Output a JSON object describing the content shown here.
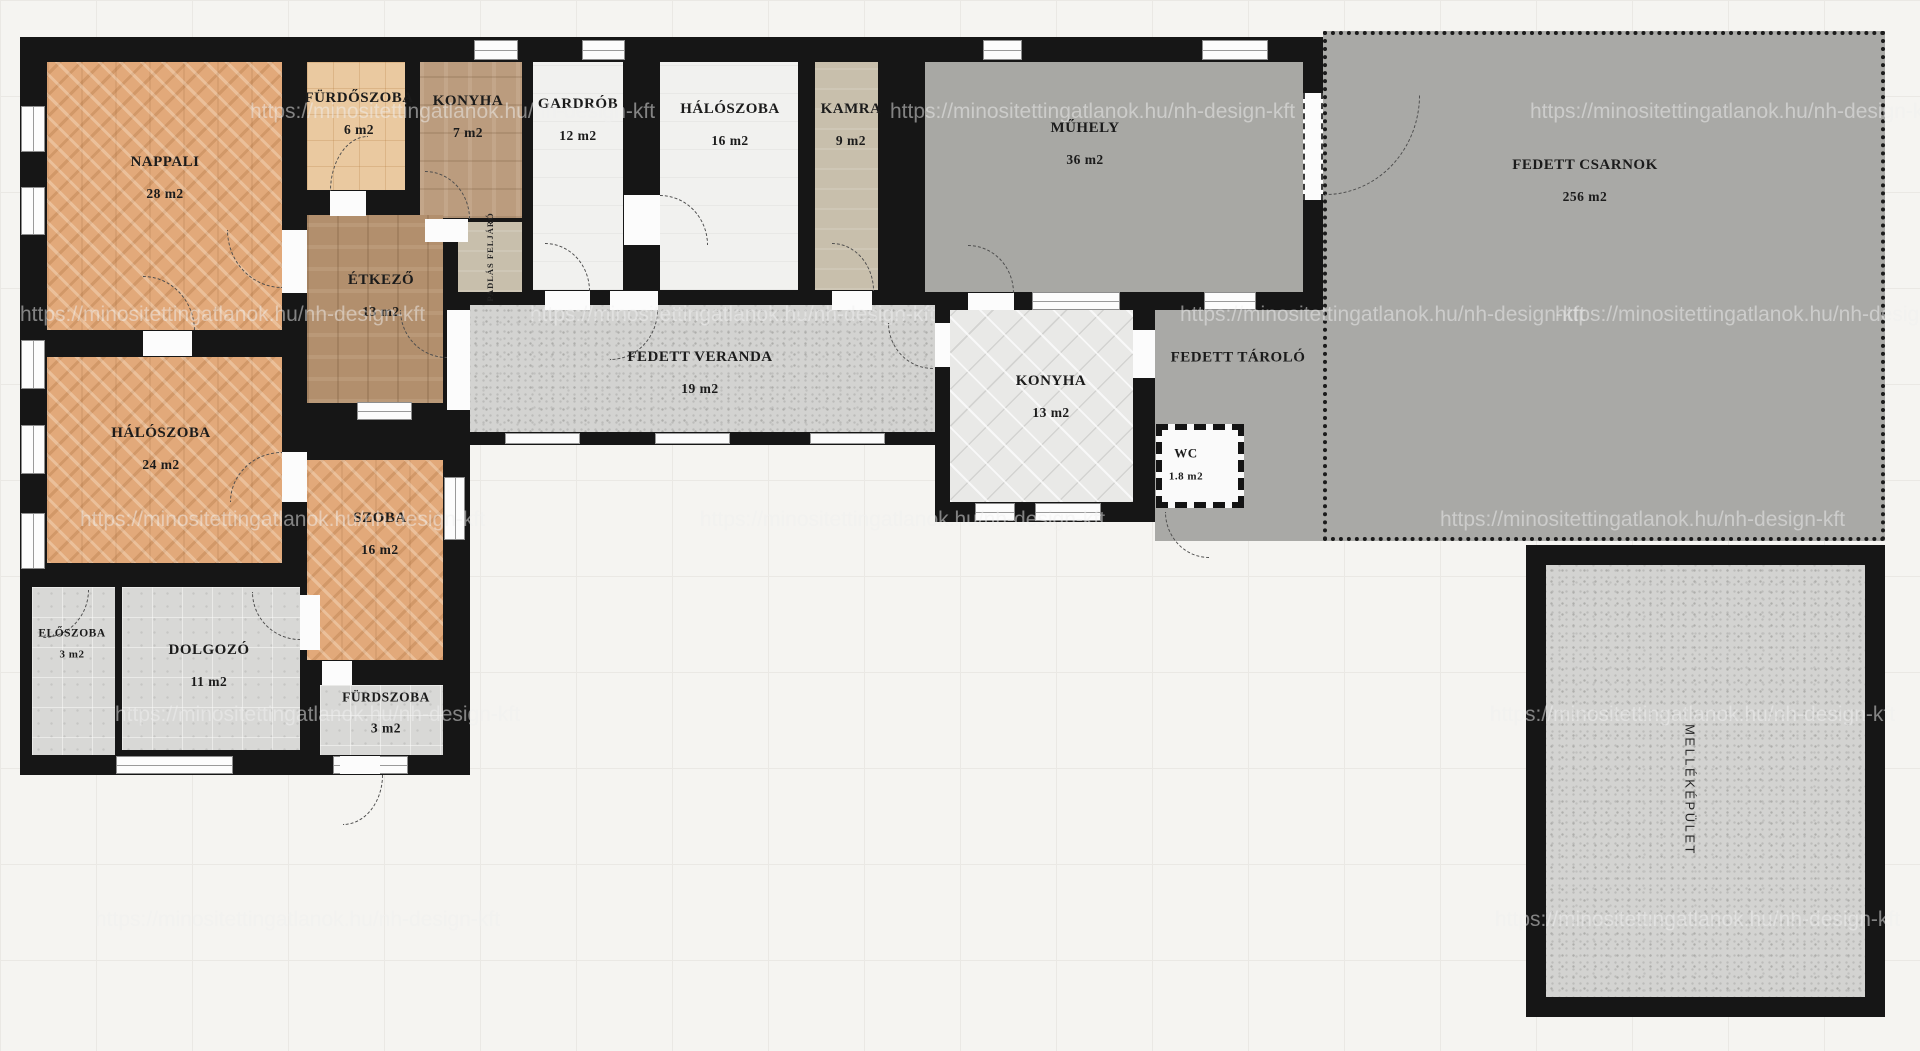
{
  "watermark": {
    "text": "https://minositettingatlanok.hu/nh-design-kft"
  },
  "colors": {
    "wall": "#161616",
    "parquet": "#e2a97a",
    "wood": "#b28f6d",
    "gray_hall": "#a9a9a6",
    "granite": "#d3d3d1",
    "background": "#f5f4f1"
  },
  "rooms": {
    "nappali": {
      "name": "NAPPALI",
      "area": "28 m2"
    },
    "furdoszoba_felso": {
      "name": "FÜRDŐSZOBA",
      "area": "6 m2"
    },
    "konyha_felso": {
      "name": "KONYHA",
      "area": "7 m2"
    },
    "gardrob": {
      "name": "GARDRÓB",
      "area": "12 m2"
    },
    "haloszoba_felso": {
      "name": "HÁLÓSZOBA",
      "area": "16 m2"
    },
    "kamra": {
      "name": "KAMRA",
      "area": "9 m2"
    },
    "muhely": {
      "name": "MŰHELY",
      "area": "36 m2"
    },
    "fedett_csarnok": {
      "name": "FEDETT CSARNOK",
      "area": "256 m2"
    },
    "etkezo": {
      "name": "ÉTKEZŐ",
      "area": "13 m2"
    },
    "padlas_feljaro": {
      "name": "PADLÁS FELJÁRÓ",
      "area": ""
    },
    "fedett_veranda": {
      "name": "FEDETT VERANDA",
      "area": "19 m2"
    },
    "konyha": {
      "name": "KONYHA",
      "area": "13 m2"
    },
    "fedett_tarolo": {
      "name": "FEDETT TÁROLÓ",
      "area": ""
    },
    "wc": {
      "name": "WC",
      "area": "1.8 m2"
    },
    "haloszoba": {
      "name": "HÁLÓSZOBA",
      "area": "24 m2"
    },
    "szoba": {
      "name": "SZOBA",
      "area": "16 m2"
    },
    "eloszoba": {
      "name": "ELŐSZOBA",
      "area": "3 m2"
    },
    "dolgozo": {
      "name": "DOLGOZÓ",
      "area": "11 m2"
    },
    "furdszoba": {
      "name": "FÜRDSZOBA",
      "area": "3 m2"
    },
    "mellekepulet": {
      "name": "MELLÉKÉPÜLET",
      "area": ""
    }
  }
}
